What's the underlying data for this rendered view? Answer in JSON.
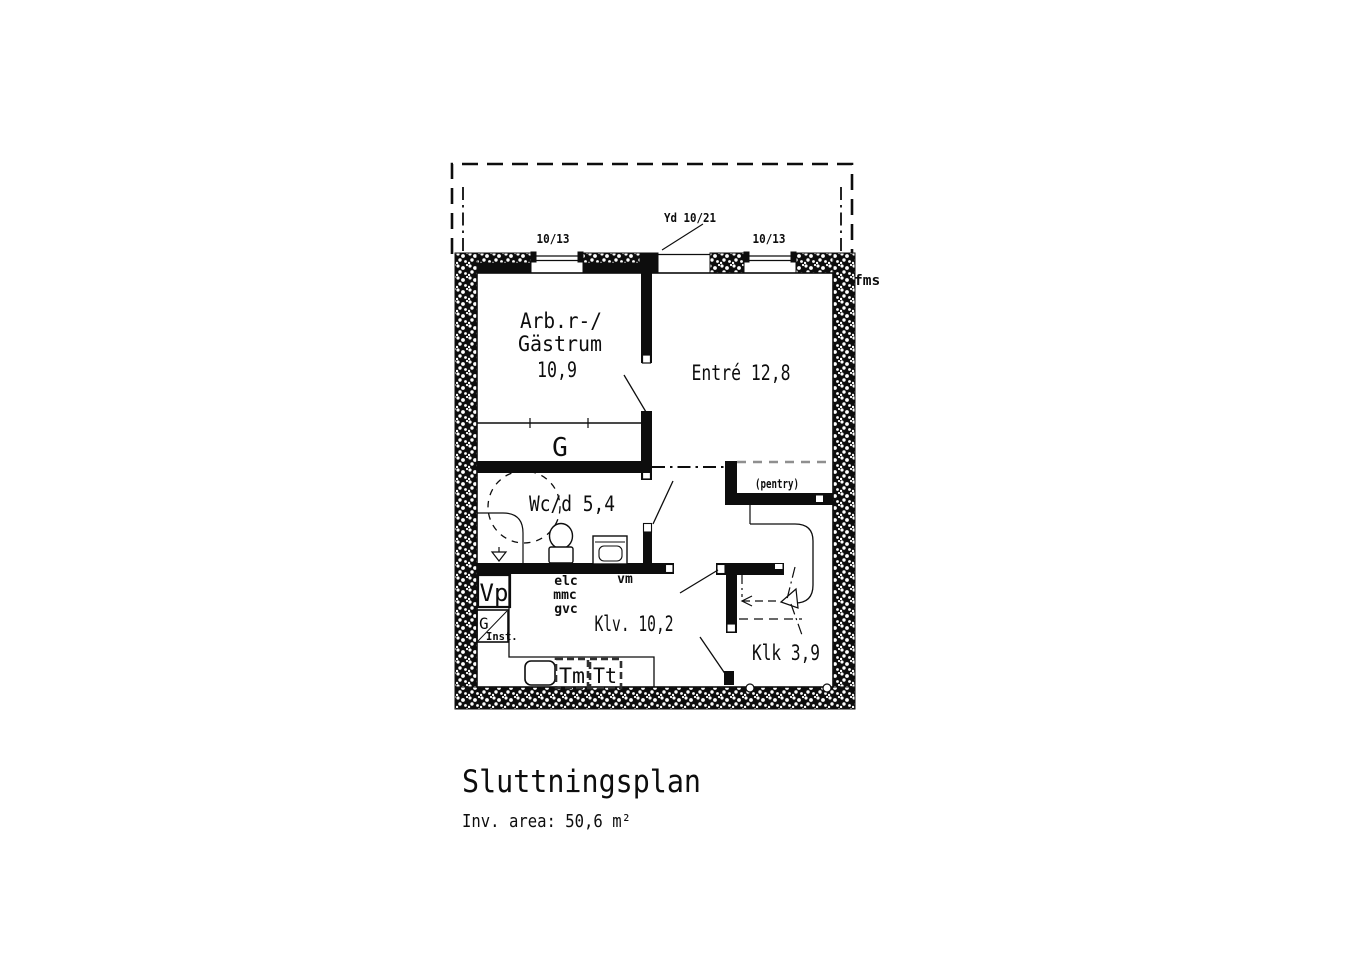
{
  "title_block": {
    "title": "Sluttningsplan",
    "area": "Inv. area: 50,6 m²"
  },
  "exterior": {
    "window_left": "10/13",
    "window_right": "10/13",
    "entry_door": "Yd 10/21",
    "facade_mark": "fms"
  },
  "rooms": {
    "guest_line1": "Arb.r-/",
    "guest_line2": "Gästrum",
    "guest_area": "10,9",
    "entre": "Entré 12,8",
    "wc": "Wc/d 5,4",
    "wardrobe": "G",
    "pantry": "(pentry)",
    "laundry": "Klv. 10,2",
    "closet": "Klk 3,9"
  },
  "equipment": {
    "vp": "Vp",
    "inst_g": "G",
    "inst": "Inst.",
    "elc": "elc",
    "mmc": "mmc",
    "gvc": "gvc",
    "vm": "vm",
    "tm": "Tm",
    "tt": "Tt"
  }
}
